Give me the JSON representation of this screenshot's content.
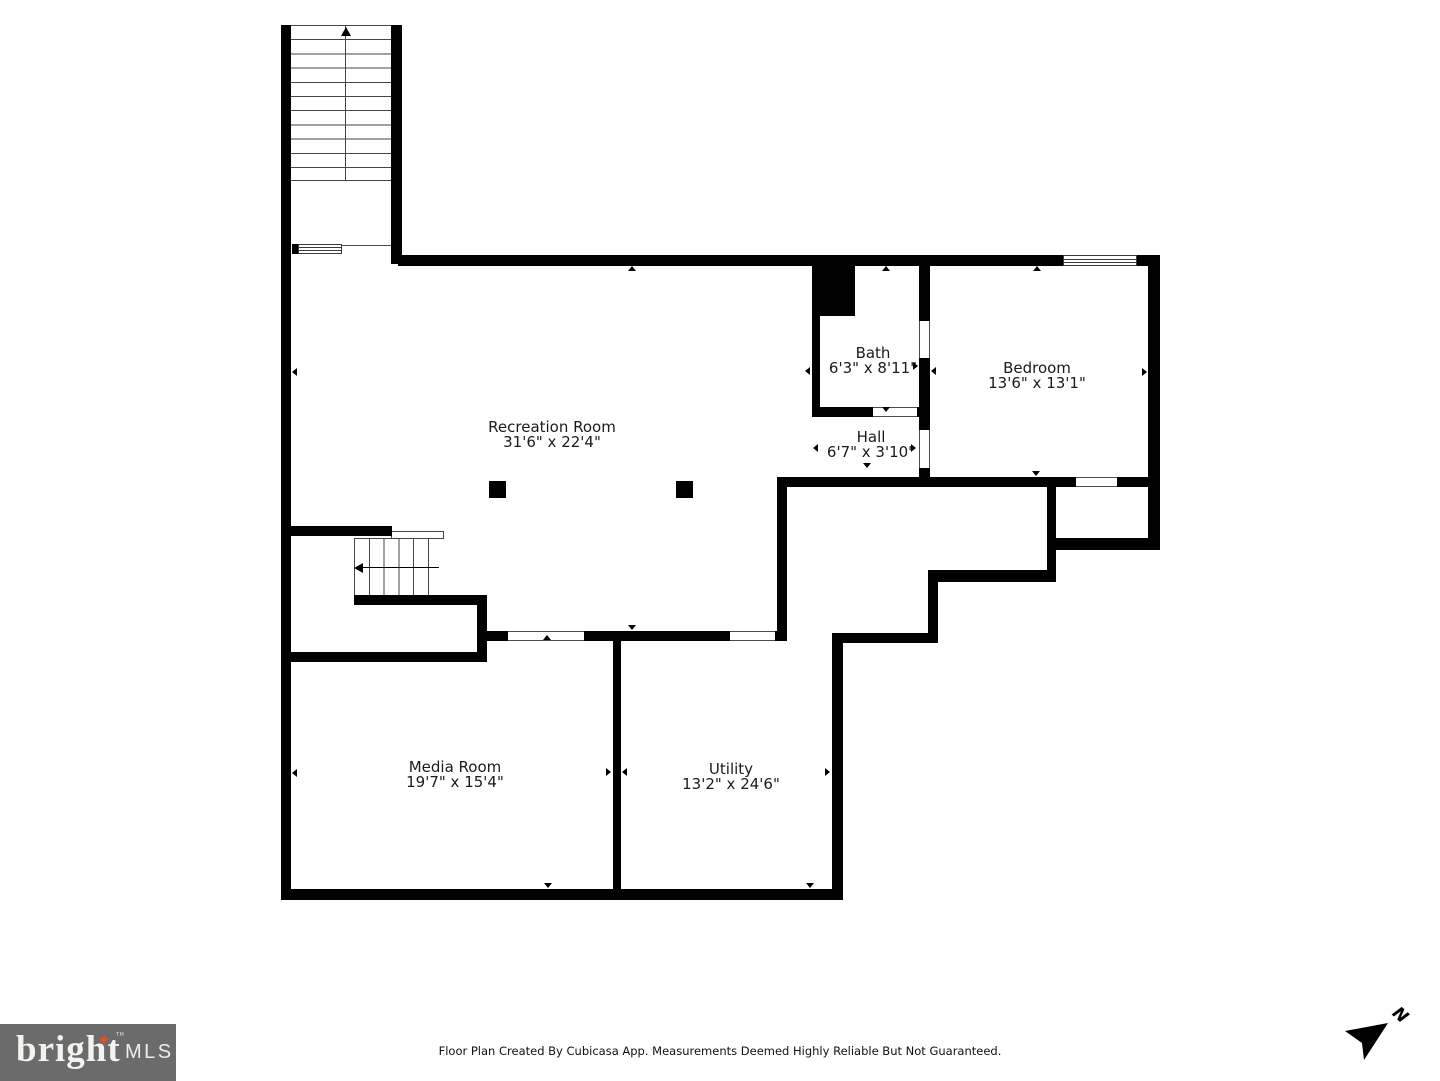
{
  "rooms": {
    "recreation": {
      "name": "Recreation Room",
      "dims": "31'6\" x 22'4\""
    },
    "bath": {
      "name": "Bath",
      "dims": "6'3\" x 8'11\""
    },
    "hall": {
      "name": "Hall",
      "dims": "6'7\" x 3'10\""
    },
    "bedroom": {
      "name": "Bedroom",
      "dims": "13'6\" x 13'1\""
    },
    "media": {
      "name": "Media Room",
      "dims": "19'7\" x 15'4\""
    },
    "utility": {
      "name": "Utility",
      "dims": "13'2\" x 24'6\""
    }
  },
  "footer": {
    "disclaimer": "Floor Plan Created By Cubicasa App. Measurements Deemed Highly Reliable But Not Guaranteed."
  },
  "logo": {
    "brand": "bright",
    "star": "✦",
    "tm": "TM",
    "suffix": "MLS"
  },
  "compass": {
    "label": "N"
  },
  "colors": {
    "wall": "#000000",
    "logo_bg": "#6b6b6b",
    "logo_star": "#e4502e",
    "text": "#1b1b1b"
  }
}
